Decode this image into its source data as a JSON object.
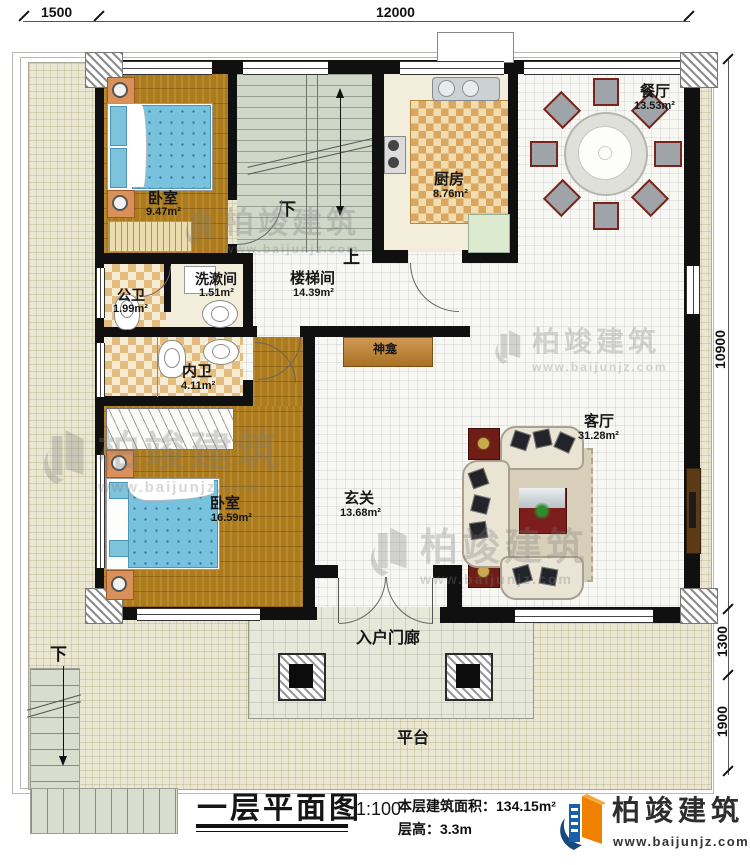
{
  "dimensions": {
    "top_left": "1500",
    "top_main": "12000",
    "right_main": "10900",
    "right_mid": "1300",
    "right_low": "1900"
  },
  "rooms": {
    "bedroom1": {
      "label": "卧室",
      "area": "9.47m²"
    },
    "stairwell": {
      "label": "楼梯间",
      "area": "14.39m²"
    },
    "kitchen": {
      "label": "厨房",
      "area": "8.76m²"
    },
    "dining": {
      "label": "餐厅",
      "area": "13.53m²"
    },
    "public_bath": {
      "label": "公卫",
      "area": "1.99m²"
    },
    "washroom": {
      "label": "洗漱间",
      "area": "1.51m²"
    },
    "inner_bath": {
      "label": "内卫",
      "area": "4.11m²"
    },
    "bedroom2": {
      "label": "卧室",
      "area": "16.59m²"
    },
    "foyer": {
      "label": "玄关",
      "area": "13.68m²"
    },
    "living": {
      "label": "客厅",
      "area": "31.28m²"
    },
    "shrine": {
      "label": "神龛"
    },
    "entry_porch": {
      "label": "入户门廊"
    },
    "terrace": {
      "label": "平台"
    }
  },
  "stair_marks": {
    "down_indoor": "下",
    "up_indoor": "上",
    "down_outdoor": "下"
  },
  "title_block": {
    "title": "一层平面图",
    "scale": "1:100",
    "area_label": "本层建筑面积：",
    "area_value": "134.15m²",
    "height_label": "层高：",
    "height_value": "3.3m"
  },
  "brand": {
    "name": "柏竣建筑",
    "url": "www.baijunjz.com"
  },
  "colors": {
    "wall": "#101010",
    "brand_blue": "#1b5eaa",
    "brand_orange": "#ee8200",
    "wood": "#ac7b1e"
  }
}
